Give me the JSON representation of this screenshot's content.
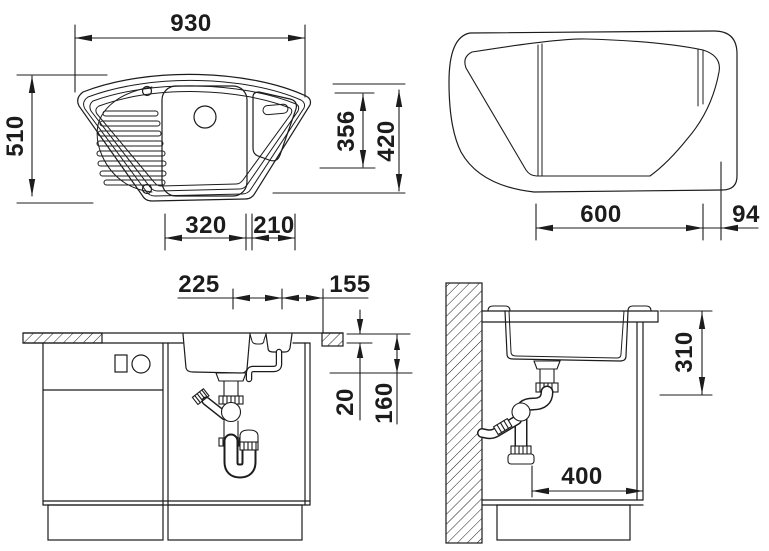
{
  "title": "Corner sink installation drawing",
  "colors": {
    "line": "#1c1c1c",
    "background": "#ffffff"
  },
  "views": {
    "plan": {
      "width": "930",
      "height": "510",
      "bowl_offset": "356",
      "right_height": "420",
      "main_bowl_width": "320",
      "small_bowl_width": "210"
    },
    "cutout": {
      "width": "600",
      "corner_offset": "94"
    },
    "front_section": {
      "drain_spacing": "225",
      "right_offset": "155",
      "counter_thickness": "20",
      "bowl_depth": "160"
    },
    "side_section": {
      "install_depth": "310",
      "cabinet_depth": "400"
    }
  }
}
